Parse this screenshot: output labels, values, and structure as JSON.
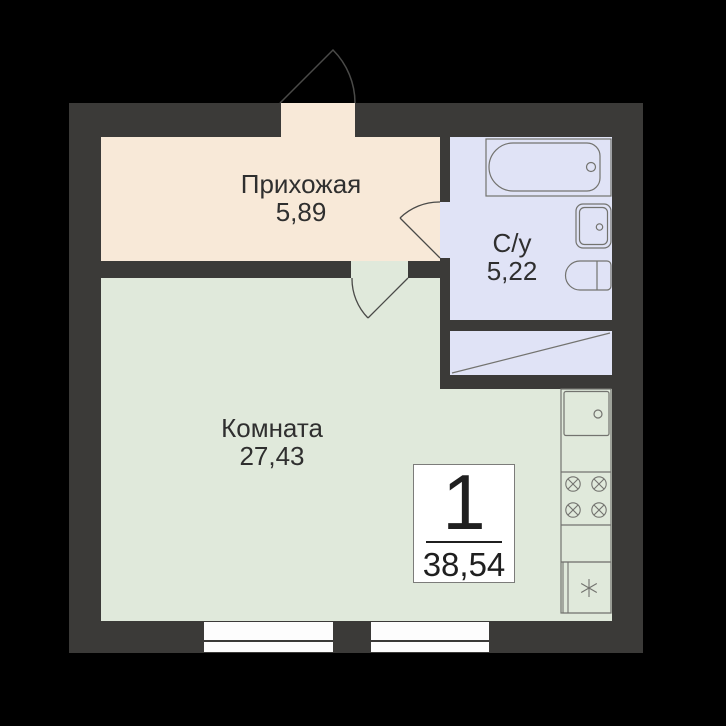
{
  "plan": {
    "rooms": [
      {
        "id": "hallway",
        "label": "Прихожая",
        "area": "5,89"
      },
      {
        "id": "bathroom",
        "label": "С/у",
        "area": "5,22"
      },
      {
        "id": "room",
        "label": "Комната",
        "area": "27,43"
      }
    ],
    "badge": {
      "apartment_rooms": "1",
      "total_area": "38,54"
    },
    "colors": {
      "background": "#000000",
      "wall": "#3b3a38",
      "hallway_floor": "#f8e9d8",
      "bathroom_floor": "#e0e3f6",
      "room_floor": "#e0e9db",
      "window": "#fdfdfd",
      "fixture_stroke": "#73736f",
      "door_stroke": "#4a4a48",
      "text": "#2f2f2f"
    }
  }
}
